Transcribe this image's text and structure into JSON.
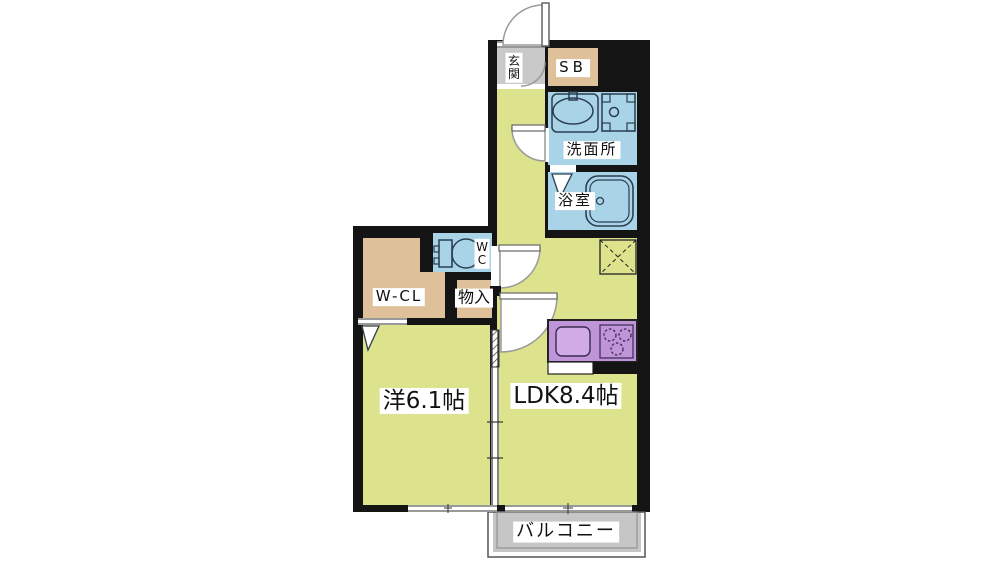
{
  "plan_title": "apartment floor plan",
  "labels": {
    "entrance": "玄関",
    "shoe_box": "SB",
    "washroom": "洗面所",
    "bathroom": "浴室",
    "toilet": "WC",
    "walk_in_closet": "W-CL",
    "storage": "物入",
    "western_room": "洋6.1帖",
    "ldk": "LDK8.4帖",
    "balcony": "バルコニー"
  },
  "room_sizes": {
    "western_room": "6.1帖",
    "ldk": "8.4帖"
  },
  "colors": {
    "wall": "#141414",
    "room_yellow": "#dde28c",
    "water_blue": "#a9d3e7",
    "closet_tan": "#dec09a",
    "entry_gray": "#c9c9c9",
    "balcony_gray": "#c6c6c6",
    "kitchen_purple": "#bf94d9",
    "kitchen_sink_purple": "#d0abe6",
    "fixture_line": "#2c3e50",
    "door_line": "#9a9a9a",
    "white": "#ffffff",
    "thin_line": "#333333"
  }
}
